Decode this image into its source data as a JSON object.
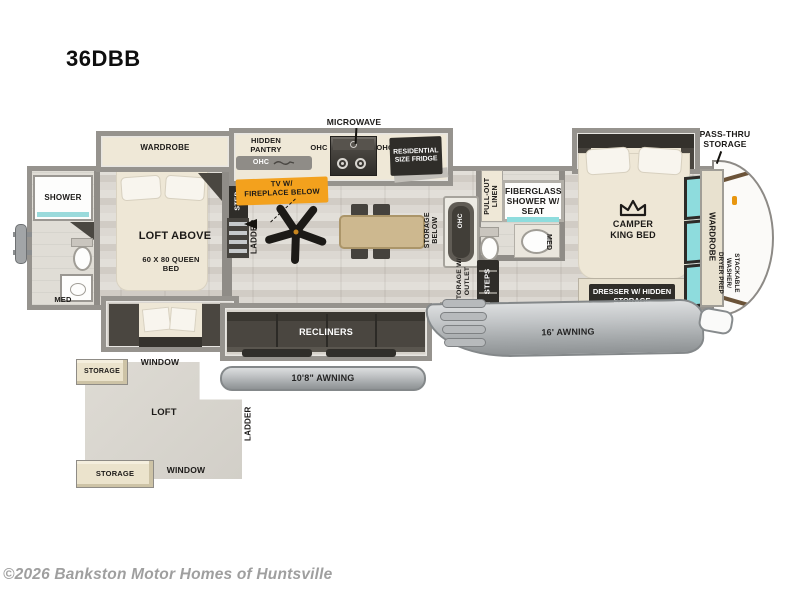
{
  "title": "36DBB",
  "watermark": "©2026 Bankston Motor Homes of Huntsville",
  "colors": {
    "wall": "#8f8c87",
    "floor_wood": "#d8d4cd",
    "slide_interior": "#efe8d7",
    "dark_fixture": "#2f2d29",
    "accent_orange": "#f3a11d",
    "window_teal": "#8edcdd",
    "awning_gray": "#b3b6b8",
    "loft_floor": "#dbd8d1",
    "watermark_gray": "#9f9f9f"
  },
  "labels": {
    "microwave": "MICROWAVE",
    "hidden_pantry": "HIDDEN PANTRY",
    "ohc": "OHC",
    "fridge": "RESIDENTIAL SIZE FRIDGE",
    "pass_thru": "PASS-THRU STORAGE",
    "wardrobe": "WARDROBE",
    "tv_line1": "TV W/",
    "tv_line2": "FIREPLACE BELOW",
    "shower": "SHOWER",
    "med": "MED",
    "loft_above": "LOFT ABOVE",
    "queen_bed": "60 X 80 QUEEN BED",
    "step": "STEP",
    "ladder": "LADDER",
    "storage_below": "STORAGE BELOW",
    "pull_out_linen": "PULL-OUT LINEN",
    "fiberglass_shower": "FIBERGLASS SHOWER W/ SEAT",
    "camper_king": "CAMPER KING BED",
    "washer_line1": "STACKABLE WASHER/",
    "washer_line2": "DRYER PREP",
    "storage_outlet": "STORAGE W/ OUTLET",
    "steps": "STEPS",
    "dresser": "DRESSER W/ HIDDEN STORAGE",
    "recliners": "RECLINERS",
    "awning_rear": "10'8\" AWNING",
    "awning_front": "16' AWNING",
    "loft": "LOFT",
    "storage": "STORAGE",
    "window": "WINDOW"
  }
}
